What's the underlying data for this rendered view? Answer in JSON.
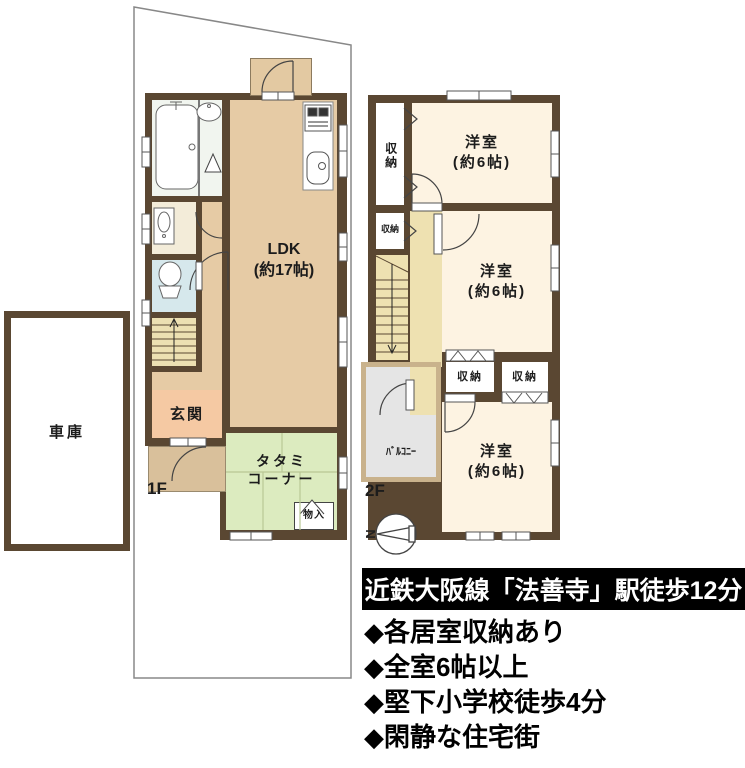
{
  "site": {
    "garage_label": "車庫"
  },
  "floor1": {
    "label": "1F",
    "rooms": {
      "ldk": "LDK\n(約17帖)",
      "genkan": "玄関",
      "tatami_corner": "タタミ\nコーナー",
      "storage": "物入"
    }
  },
  "floor2": {
    "label": "2F",
    "rooms": {
      "bedroom1": "洋室\n(約6帖)",
      "bedroom2": "洋室\n(約6帖)",
      "bedroom3": "洋室\n(約6帖)",
      "closet1": "収納",
      "closet2": "収納",
      "closet3": "収納",
      "closet4": "収納",
      "balcony": "ﾊﾞﾙｺﾆｰ"
    }
  },
  "compass": {
    "north_label": "N"
  },
  "banner": {
    "text": "近鉄大阪線「法善寺」駅徒歩12分"
  },
  "features": [
    "◆各居室収納あり",
    "◆全室6帖以上",
    "◆堅下小学校徒歩4分",
    "◆閑静な住宅街"
  ],
  "colors": {
    "wall": "#5a4732",
    "ldk_floor": "#e6cba5",
    "tatami_floor": "#dcebbf",
    "genkan_floor": "#f5c9a3",
    "bedroom_floor": "#fdf3e2",
    "hall_floor": "#eee1b1",
    "toilet_floor": "#d6e8ec",
    "bathroom_floor": "#f1f5ef",
    "balcony_floor": "#e5e5e5",
    "balcony_wall": "#c9b28c",
    "porch_floor": "#d9c09b",
    "banner_bg": "#000000",
    "banner_fg": "#ffffff"
  }
}
